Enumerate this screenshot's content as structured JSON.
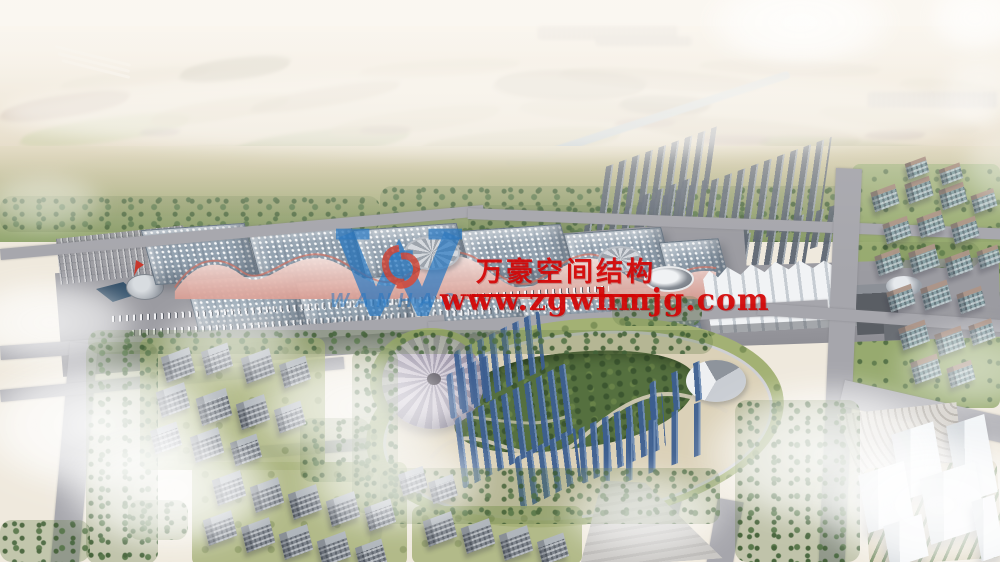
{
  "watermark": {
    "brand_name": "万豪空间结构",
    "website": "www.zgwhmjg.com",
    "logo_text": "WANHAO",
    "brand_red": "#d40404",
    "logo_blue": "#2476c2",
    "logo_red": "#d23b2a"
  }
}
